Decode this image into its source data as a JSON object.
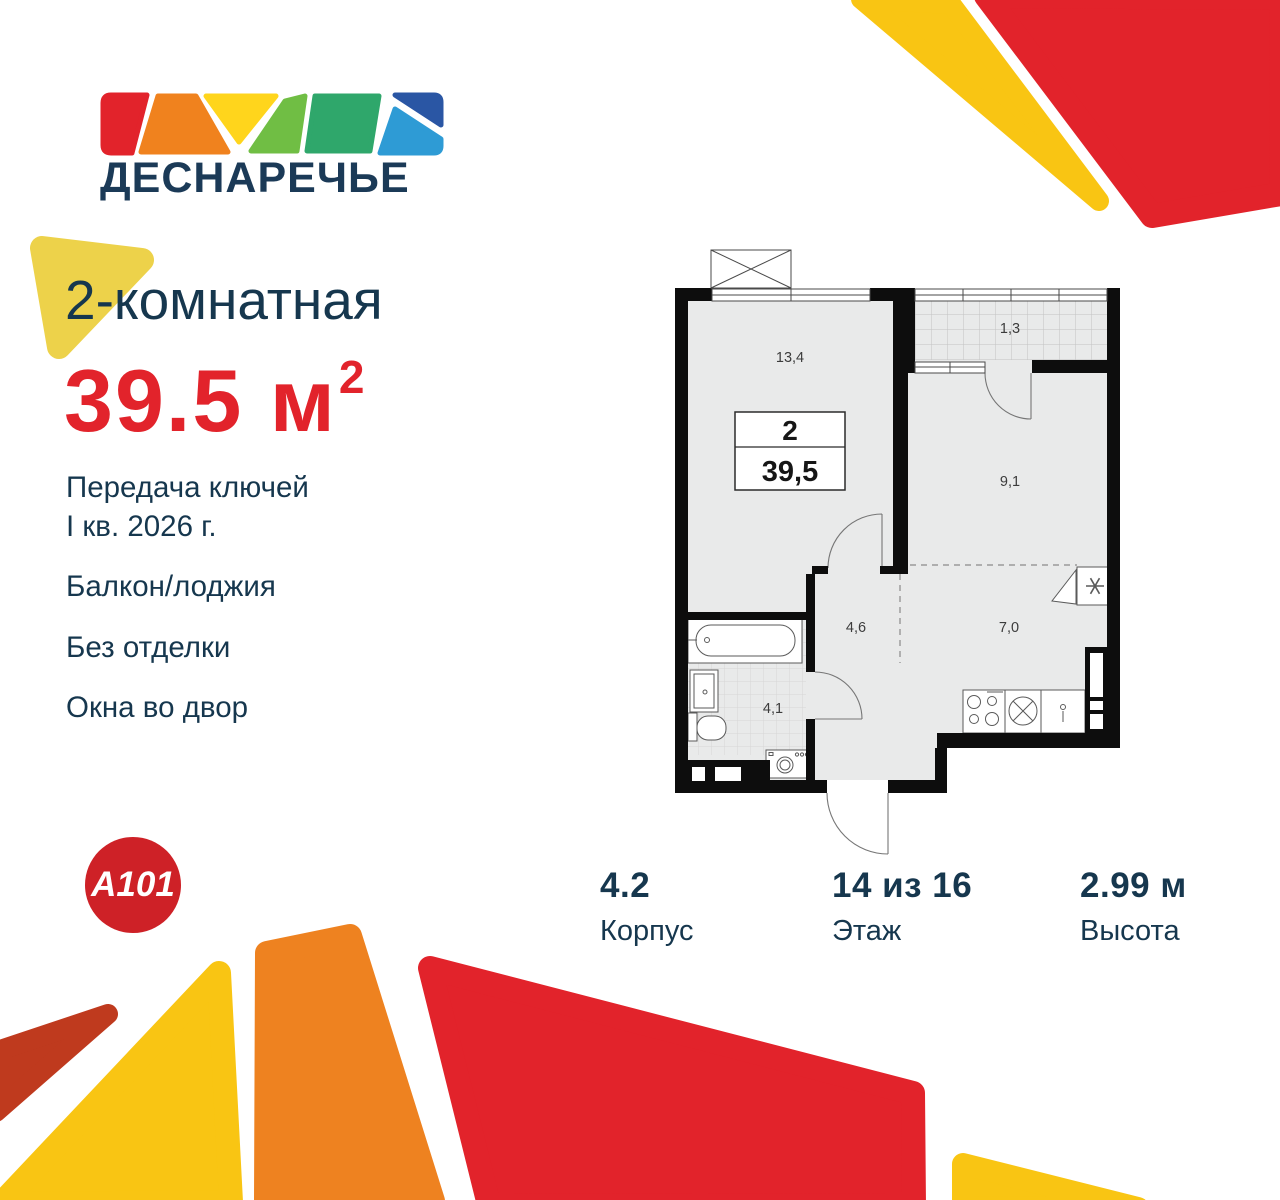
{
  "logo": {
    "name": "ДЕСНАРЕЧЬЕ"
  },
  "header": {
    "rooms_title": "2-комнатная",
    "area_value": "39.5 м",
    "area_sup": "2"
  },
  "features": [
    {
      "text": "Передача ключей\nI кв. 2026 г."
    },
    {
      "text": "Балкон/лоджия"
    },
    {
      "text": "Без отделки"
    },
    {
      "text": "Окна во двор"
    }
  ],
  "plan": {
    "spec_rooms": "2",
    "spec_area": "39,5",
    "labels": {
      "living": "13,4",
      "loggia": "1,3",
      "bedroom": "9,1",
      "hall": "4,6",
      "kitchen": "7,0",
      "bath": "4,1"
    }
  },
  "stats": [
    {
      "value": "4.2",
      "label": "Корпус"
    },
    {
      "value": "14 из 16",
      "label": "Этаж"
    },
    {
      "value": "2.99 м",
      "label": "Высота"
    }
  ],
  "brand": {
    "logo": "A101"
  },
  "colors": {
    "navy": "#16374E",
    "red": "#E2232B",
    "brand_red": "#CE2127",
    "yellow_soft": "#EDD24A",
    "yellow": "#F9C513",
    "orange": "#EE8220",
    "brick": "#BF3A1E",
    "plan_wall": "#0D0D0D",
    "plan_floor": "#E9EAEA"
  }
}
